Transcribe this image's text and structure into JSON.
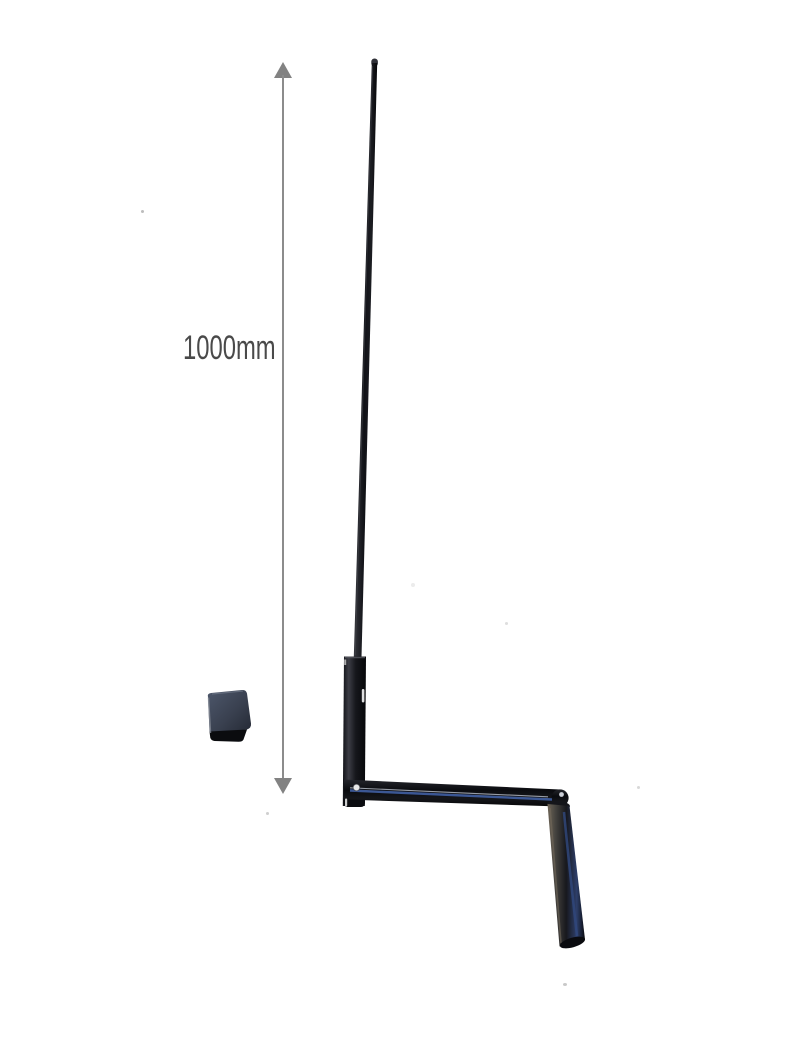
{
  "image": {
    "background_color": "#ffffff",
    "objects": [
      "crank-handle",
      "rubber-cap",
      "dimension-annotation"
    ]
  },
  "dimension": {
    "label": "1000mm",
    "arrow_color": "#828282",
    "line_color": "#8c8c8c",
    "label_color": "#4a4a4a"
  },
  "photo": {
    "colors": {
      "metal_black": "#0a0b0f",
      "metal_sheen": "#3c3d45",
      "blue_highlight": "#3e5c9c",
      "light_stripe": "#b9bfca",
      "pin_white": "#e8e8e8",
      "grip_brown_edge": "#6e6557",
      "cap_face": "#4d576b",
      "cap_shadow": "#0b0c0f"
    }
  }
}
